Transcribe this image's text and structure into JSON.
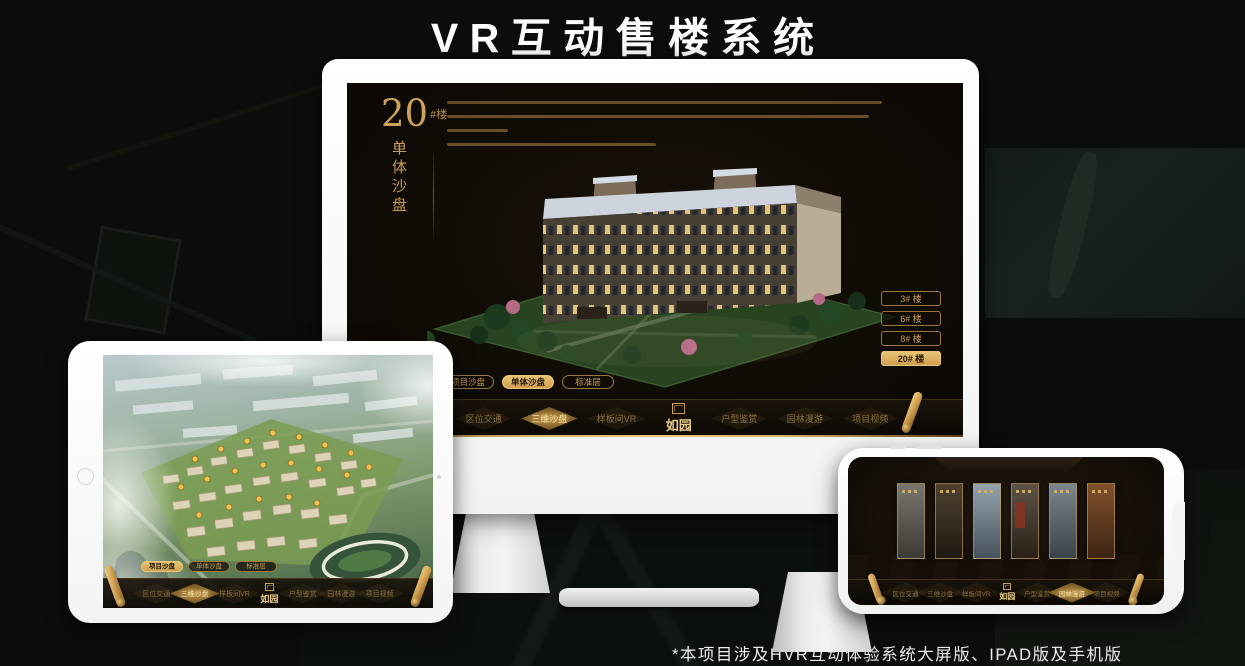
{
  "page": {
    "title": "VR互动售楼系统",
    "footnote": "*本项目涉及HVR互动体验系统大屏版、IPAD版及手机版"
  },
  "colors": {
    "gold": "#c9a052",
    "gold_bright": "#e3bd6e",
    "screen_dark": "#130e08",
    "background": "#0a0d0b"
  },
  "monitor": {
    "headline": {
      "number": "20",
      "unit": "#楼",
      "vertical_title": "单体沙盘"
    },
    "floor_buttons": [
      {
        "label": "3# 楼",
        "active": false
      },
      {
        "label": "6# 楼",
        "active": false
      },
      {
        "label": "8# 楼",
        "active": false
      },
      {
        "label": "20# 楼",
        "active": true
      }
    ],
    "view_tabs": [
      {
        "label": "项目沙盘",
        "active": false
      },
      {
        "label": "单体沙盘",
        "active": true
      },
      {
        "label": "标准层",
        "active": false
      }
    ],
    "nav": {
      "logo": "如园",
      "items": [
        {
          "label": "区位交通",
          "active": false
        },
        {
          "label": "三维沙盘",
          "active": true
        },
        {
          "label": "样板间VR",
          "active": false
        },
        {
          "label": "户型鉴赏",
          "active": false
        },
        {
          "label": "园林漫游",
          "active": false
        },
        {
          "label": "项目视频",
          "active": false
        }
      ]
    }
  },
  "tablet": {
    "view_tabs": [
      {
        "label": "项目沙盘",
        "active": true
      },
      {
        "label": "单体沙盘",
        "active": false
      },
      {
        "label": "标准层",
        "active": false
      }
    ],
    "nav": {
      "logo": "如园",
      "items": [
        {
          "label": "区位交通",
          "active": false
        },
        {
          "label": "三维沙盘",
          "active": true
        },
        {
          "label": "样板间VR",
          "active": false
        },
        {
          "label": "户型鉴赏",
          "active": false
        },
        {
          "label": "园林漫游",
          "active": false
        },
        {
          "label": "项目视频",
          "active": false
        }
      ]
    }
  },
  "phone": {
    "nav": {
      "logo": "如园",
      "items": [
        {
          "label": "区位交通",
          "active": false
        },
        {
          "label": "三维沙盘",
          "active": false
        },
        {
          "label": "样板间VR",
          "active": false
        },
        {
          "label": "户型鉴赏",
          "active": false
        },
        {
          "label": "园林漫游",
          "active": true
        },
        {
          "label": "项目视频",
          "active": false
        }
      ]
    }
  }
}
